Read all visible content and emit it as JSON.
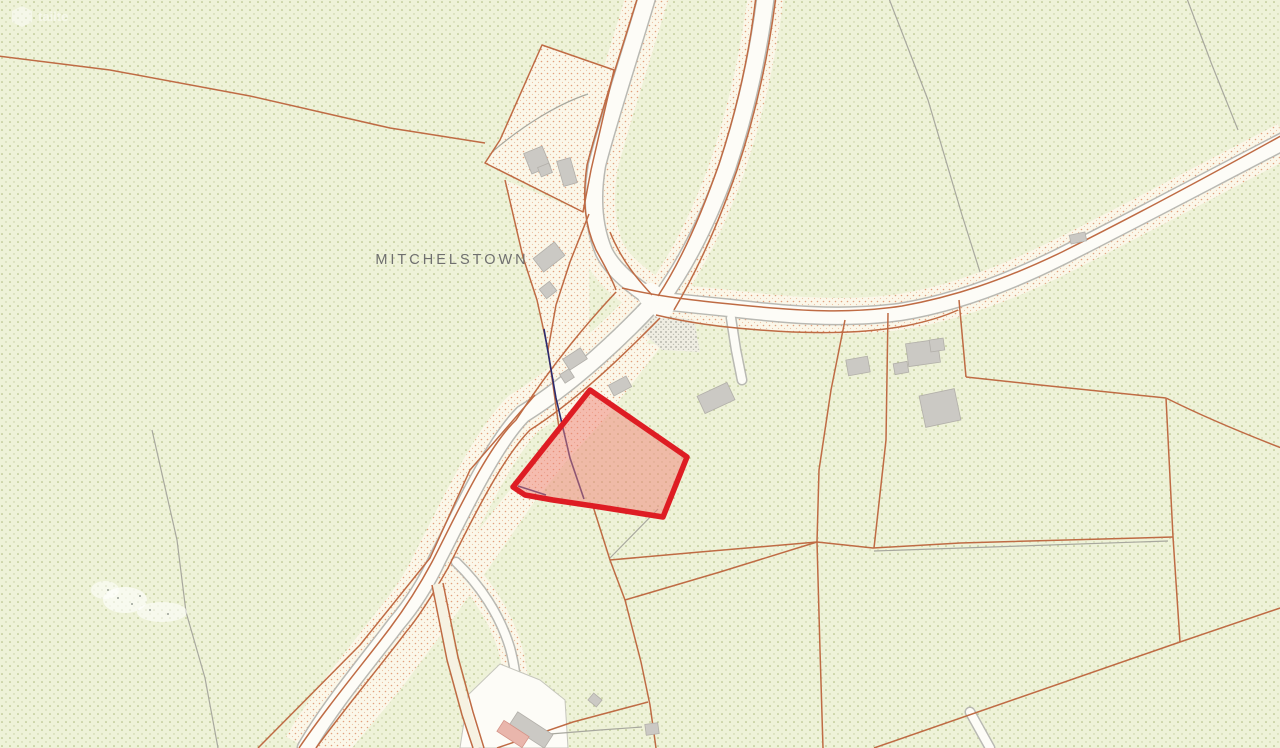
{
  "map": {
    "place_label": "MITCHELSTOWN",
    "watermark": "tailte",
    "highlighted_parcel": {
      "fill_color": "#f08276",
      "fill_opacity": "0.5",
      "outline_color": "#de1c23",
      "vertices": [
        [
          590,
          390
        ],
        [
          687,
          457
        ],
        [
          663,
          517
        ],
        [
          600,
          507
        ],
        [
          553,
          500
        ],
        [
          525,
          495
        ],
        [
          513,
          487
        ]
      ]
    },
    "colors": {
      "background": "#eef2d8",
      "background_dot": "#aab878",
      "boundary_line": "#bf6b44",
      "road_fill": "#fdfcf7",
      "road_casing": "#b9b9b3",
      "verge_base": "#fbf7e9",
      "verge_dot": "#e2a07c",
      "building_fill": "#cbc9c4",
      "old_boundary_gray": "#a8a89e",
      "survey_line_navy": "#2b2b70",
      "label_gray": "#6f6f6f"
    }
  }
}
